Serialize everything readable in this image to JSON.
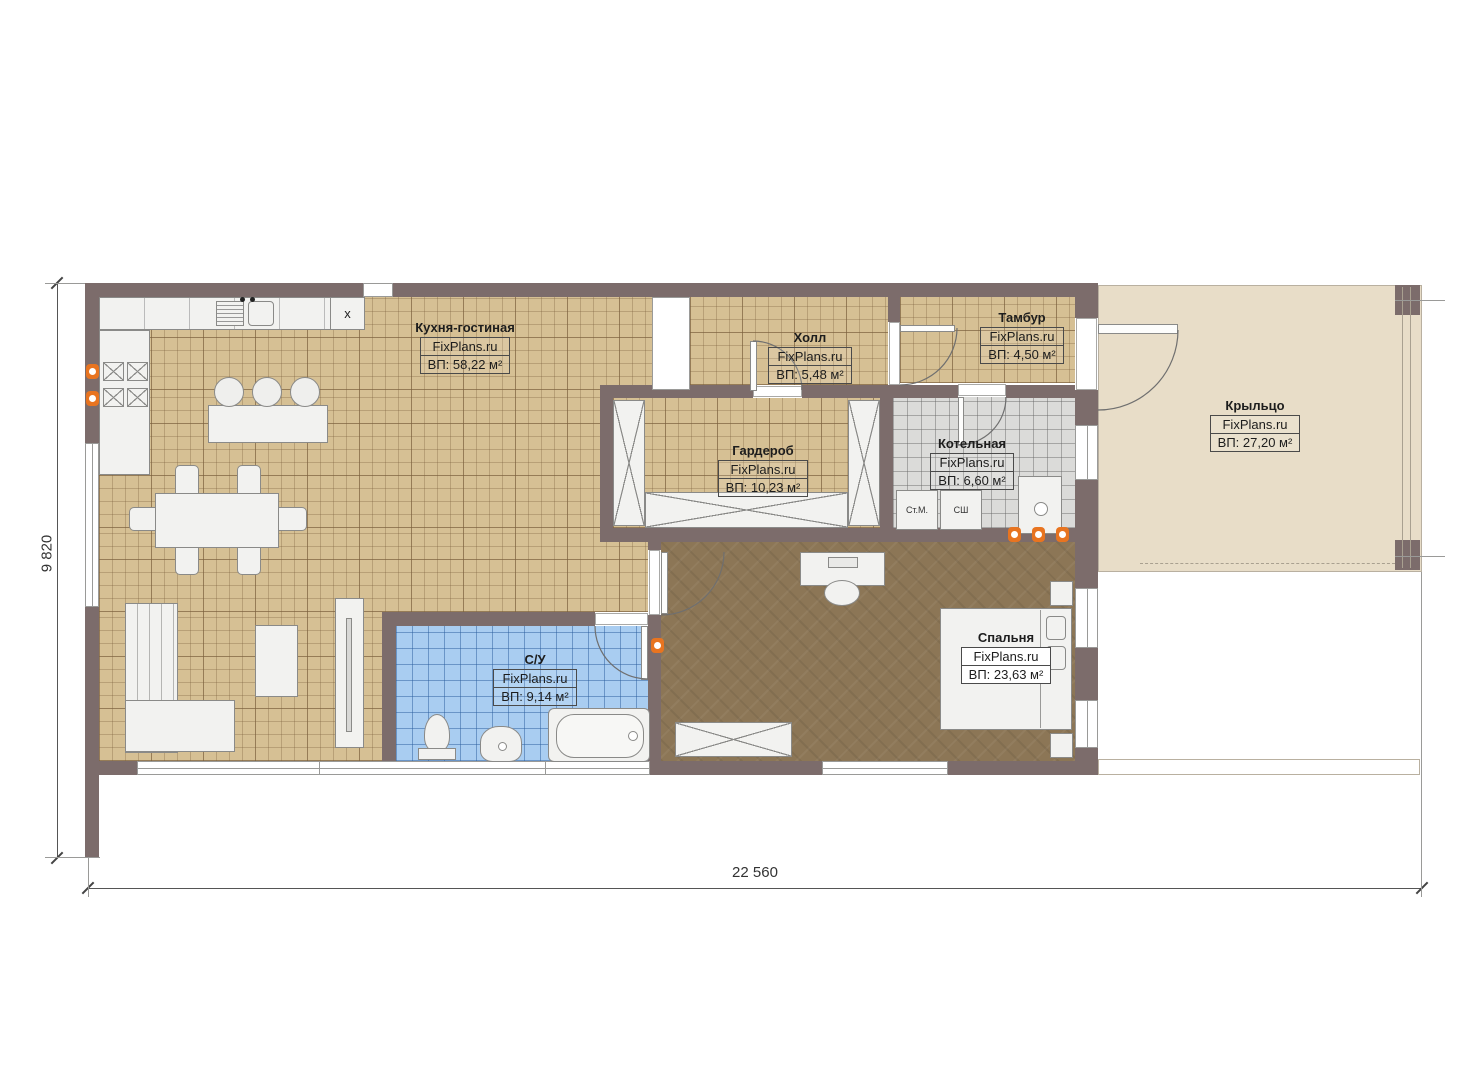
{
  "brand": "FixPlans.ru",
  "dimensions": {
    "width": "22 560",
    "height": "9 820"
  },
  "rooms": [
    {
      "name": "Кухня-гостиная",
      "brand": "FixPlans.ru",
      "area": "ВП: 58,22 м²"
    },
    {
      "name": "Холл",
      "brand": "FixPlans.ru",
      "area": "ВП: 5,48 м²"
    },
    {
      "name": "Тамбур",
      "brand": "FixPlans.ru",
      "area": "ВП: 4,50 м²"
    },
    {
      "name": "Гардероб",
      "brand": "FixPlans.ru",
      "area": "ВП: 10,23 м²"
    },
    {
      "name": "Котельная",
      "brand": "FixPlans.ru",
      "area": "ВП: 6,60 м²"
    },
    {
      "name": "Спальня",
      "brand": "FixPlans.ru",
      "area": "ВП: 23,63 м²"
    },
    {
      "name": "С/У",
      "brand": "FixPlans.ru",
      "area": "ВП: 9,14 м²"
    },
    {
      "name": "Крыльцо",
      "brand": "FixPlans.ru",
      "area": "ВП: 27,20 м²"
    }
  ],
  "labels": {
    "washing_machine": "Ст.М.",
    "drying_cabinet": "СШ",
    "kitchen_appliance": "x"
  },
  "colors": {
    "wall": "#7c6c6b",
    "floor_beige": "#d6c094",
    "floor_blue": "#a9cdf1",
    "floor_gray": "#dbdbd9",
    "floor_brown": "#8c7656",
    "floor_porch": "#e8ddc8",
    "accent_orange": "#e87420"
  }
}
